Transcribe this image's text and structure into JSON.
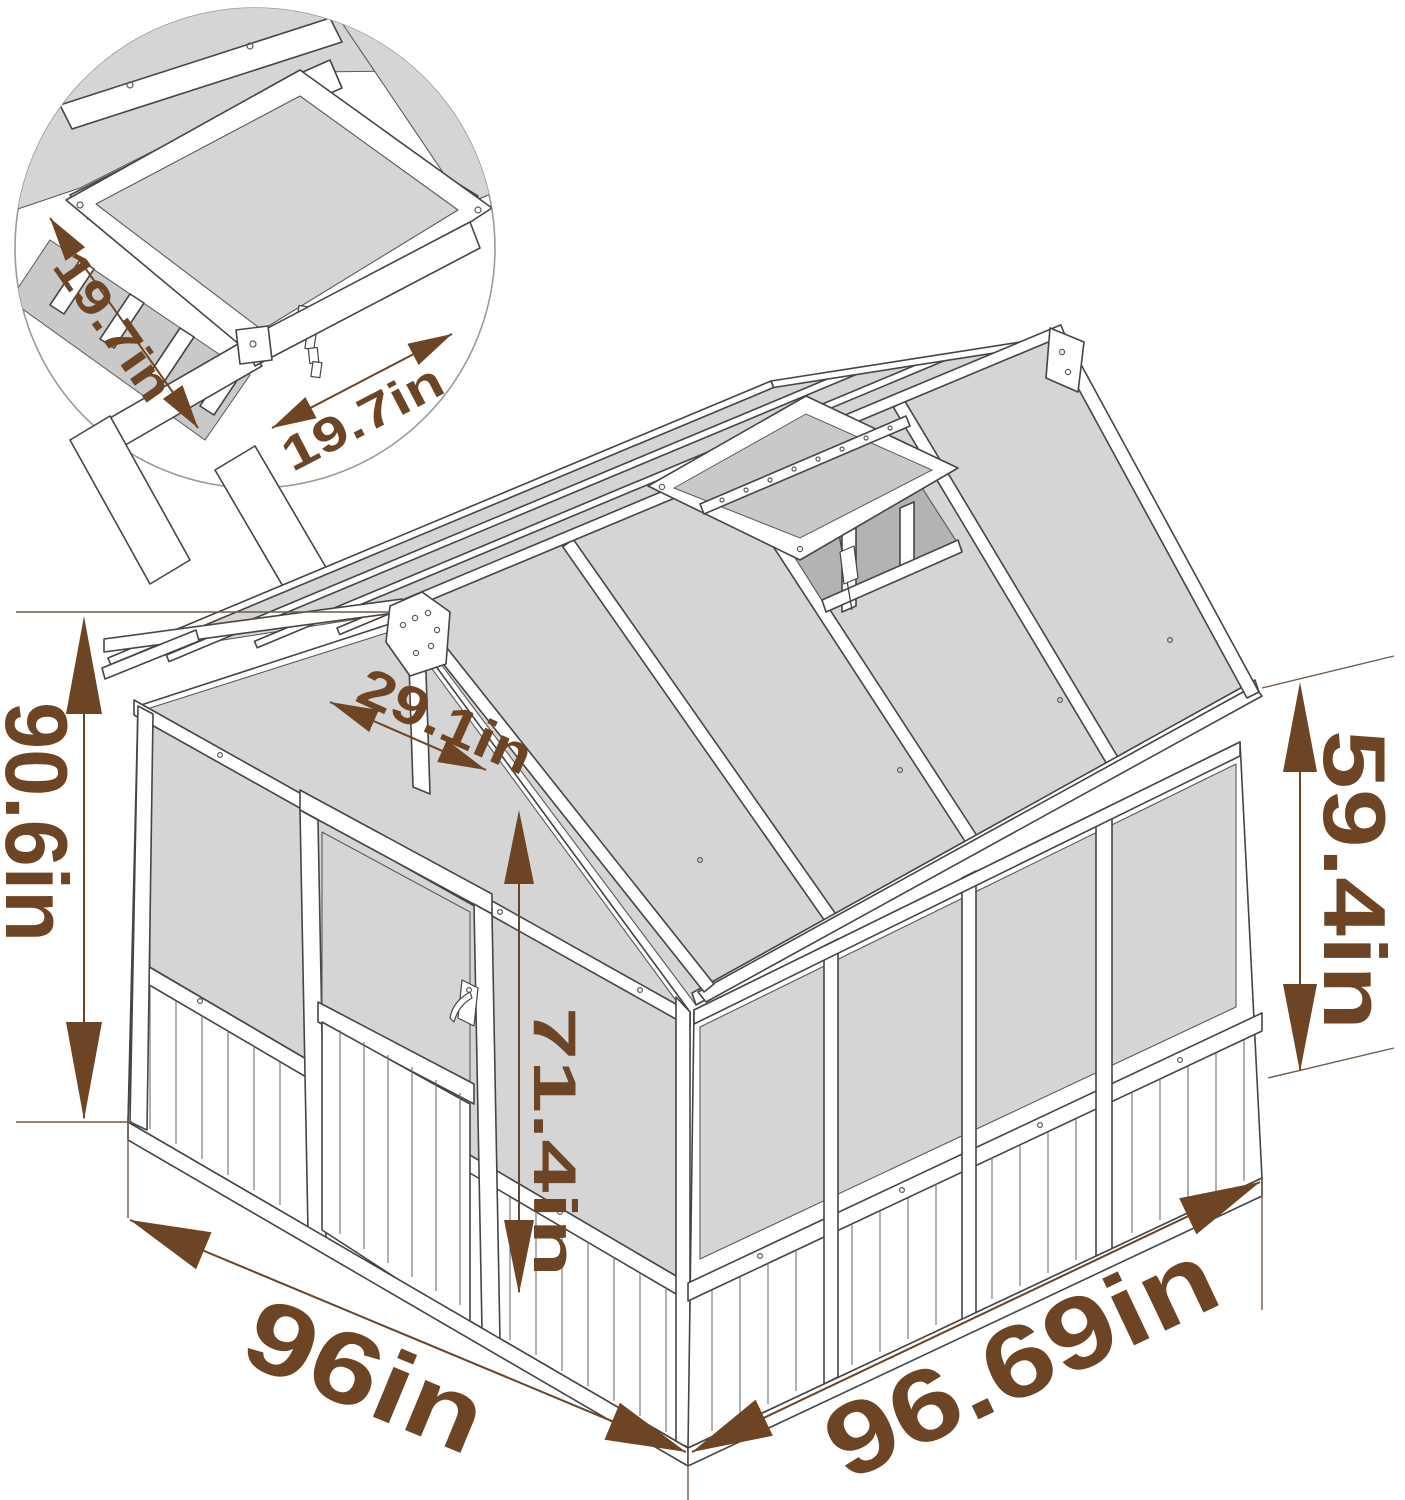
{
  "figure": {
    "kind": "product-dimension-diagram",
    "subject": "wooden greenhouse with polycarbonate panels and opening roof vent"
  },
  "inset": {
    "labels": {
      "vent_width": "19.7in",
      "vent_depth": "19.7in"
    }
  },
  "dimensions": {
    "overall_height": "90.6in",
    "side_wall_height": "59.4in",
    "door_width": "29.1in",
    "door_height": "71.4in",
    "front_width": "96in",
    "side_depth": "96.69in"
  },
  "colors": {
    "dimension_text": "#6d4524",
    "panel_gray": "#d5d5d5",
    "outline": "#454545",
    "inset_border": "#9b9b9b",
    "background": "#ffffff"
  }
}
